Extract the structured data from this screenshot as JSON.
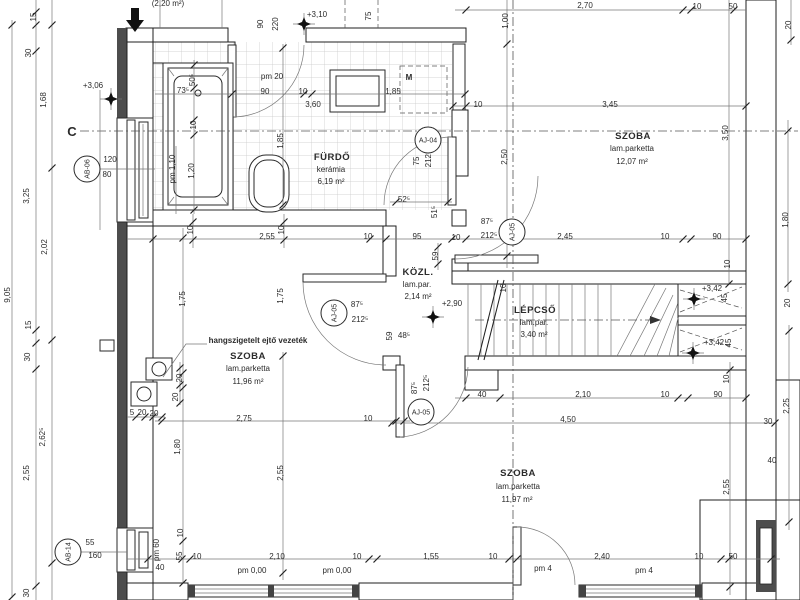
{
  "drawing": {
    "type": "architectural floor plan",
    "section_marker": "C",
    "note": "hangszigetelt ejtő vezeték"
  },
  "rooms": [
    {
      "name": "FÜRDŐ",
      "finish": "kerámia",
      "area": "6,19 m²"
    },
    {
      "name": "SZOBA",
      "finish": "lam.parketta",
      "area": "12,07 m²"
    },
    {
      "name": "KÖZL.",
      "finish": "lam.par.",
      "area": "2,14 m²"
    },
    {
      "name": "LÉPCSŐ",
      "finish": "lam.par.",
      "area": "3,40 m²"
    },
    {
      "name": "SZOBA",
      "finish": "lam.parketta",
      "area": "11,96 m²"
    },
    {
      "name": "SZOBA",
      "finish": "lam.parketta",
      "area": "11,97 m²"
    }
  ],
  "level_marks": [
    {
      "t": "+3,06",
      "x": 93,
      "y": 88
    },
    {
      "t": "+3,10",
      "x": 317,
      "y": 17
    },
    {
      "t": "+2,90",
      "x": 452,
      "y": 306
    },
    {
      "t": "+3,42",
      "x": 712,
      "y": 291
    },
    {
      "t": "+3,42",
      "x": 714,
      "y": 345
    }
  ],
  "tags": [
    {
      "id": "AB-06",
      "x": 87,
      "y": 169,
      "rot": 1
    },
    {
      "id": "AB-14",
      "x": 68,
      "y": 552,
      "rot": 1
    },
    {
      "id": "AJ-04",
      "x": 428,
      "y": 140,
      "rot": 0
    },
    {
      "id": "AJ-05",
      "x": 334,
      "y": 313,
      "rot": 1
    },
    {
      "id": "AJ-05",
      "x": 512,
      "y": 232,
      "rot": 1
    },
    {
      "id": "AJ-05",
      "x": 421,
      "y": 412,
      "rot": 0
    }
  ],
  "annotations": [
    {
      "t": "(2,20 m²)",
      "x": 168,
      "y": 6
    },
    {
      "t": "2,70",
      "x": 585,
      "y": 8
    },
    {
      "t": "10",
      "x": 697,
      "y": 9
    },
    {
      "t": "50",
      "x": 733,
      "y": 9
    },
    {
      "t": "90",
      "x": 263,
      "y": 24,
      "r": 1
    },
    {
      "t": "220",
      "x": 278,
      "y": 24,
      "r": 1
    },
    {
      "t": "75",
      "x": 371,
      "y": 16,
      "r": 1
    },
    {
      "t": "1,00",
      "x": 508,
      "y": 21,
      "r": 1
    },
    {
      "t": "20",
      "x": 791,
      "y": 25,
      "r": 1
    },
    {
      "t": "pm 20",
      "x": 272,
      "y": 79
    },
    {
      "t": "90",
      "x": 265,
      "y": 94
    },
    {
      "t": "10",
      "x": 303,
      "y": 94
    },
    {
      "t": "3,60",
      "x": 313,
      "y": 107
    },
    {
      "t": "1,85",
      "x": 393,
      "y": 94
    },
    {
      "t": "73⁵",
      "x": 183,
      "y": 93
    },
    {
      "t": "50⁵",
      "x": 195,
      "y": 80,
      "r": 1
    },
    {
      "t": "10",
      "x": 196,
      "y": 125,
      "r": 1
    },
    {
      "t": "pm 1,10",
      "x": 175,
      "y": 169,
      "r": 1
    },
    {
      "t": "1,20",
      "x": 194,
      "y": 171,
      "r": 1
    },
    {
      "t": "1,85",
      "x": 283,
      "y": 141,
      "r": 1
    },
    {
      "t": "M",
      "x": 409,
      "y": 80,
      "b": 1
    },
    {
      "t": "10",
      "x": 478,
      "y": 107
    },
    {
      "t": "3,45",
      "x": 610,
      "y": 107
    },
    {
      "t": "2,50",
      "x": 507,
      "y": 157,
      "r": 1
    },
    {
      "t": "3,50",
      "x": 728,
      "y": 133,
      "r": 1
    },
    {
      "t": "1,80",
      "x": 788,
      "y": 220,
      "r": 1
    },
    {
      "t": "10",
      "x": 193,
      "y": 230,
      "r": 1
    },
    {
      "t": "2,55",
      "x": 267,
      "y": 239
    },
    {
      "t": "10",
      "x": 284,
      "y": 230,
      "r": 1
    },
    {
      "t": "10",
      "x": 368,
      "y": 239
    },
    {
      "t": "95",
      "x": 417,
      "y": 239
    },
    {
      "t": "10",
      "x": 456,
      "y": 240
    },
    {
      "t": "2,45",
      "x": 565,
      "y": 239
    },
    {
      "t": "10",
      "x": 665,
      "y": 239
    },
    {
      "t": "90",
      "x": 717,
      "y": 239
    },
    {
      "t": "52⁵",
      "x": 404,
      "y": 202
    },
    {
      "t": "51⁵",
      "x": 437,
      "y": 212,
      "r": 1
    },
    {
      "t": "75",
      "x": 419,
      "y": 161,
      "r": 1
    },
    {
      "t": "212⁵",
      "x": 431,
      "y": 159,
      "r": 1
    },
    {
      "t": "59",
      "x": 438,
      "y": 256,
      "r": 1
    },
    {
      "t": "87⁵",
      "x": 487,
      "y": 224
    },
    {
      "t": "212⁵",
      "x": 489,
      "y": 238
    },
    {
      "t": "87⁵",
      "x": 357,
      "y": 307
    },
    {
      "t": "212⁵",
      "x": 360,
      "y": 322
    },
    {
      "t": "87⁵",
      "x": 417,
      "y": 388,
      "r": 1
    },
    {
      "t": "212⁵",
      "x": 429,
      "y": 383,
      "r": 1
    },
    {
      "t": "59",
      "x": 392,
      "y": 336,
      "r": 1
    },
    {
      "t": "48⁵",
      "x": 404,
      "y": 338
    },
    {
      "t": "1,75",
      "x": 185,
      "y": 299,
      "r": 1
    },
    {
      "t": "1,75",
      "x": 283,
      "y": 296,
      "r": 1
    },
    {
      "t": "10",
      "x": 506,
      "y": 288,
      "r": 1
    },
    {
      "t": "10",
      "x": 730,
      "y": 264,
      "r": 1
    },
    {
      "t": "45",
      "x": 727,
      "y": 298,
      "r": 1
    },
    {
      "t": "45",
      "x": 731,
      "y": 343,
      "r": 1
    },
    {
      "t": "10",
      "x": 729,
      "y": 379,
      "r": 1
    },
    {
      "t": "20",
      "x": 790,
      "y": 303,
      "r": 1
    },
    {
      "t": "20",
      "x": 182,
      "y": 378,
      "r": 1
    },
    {
      "t": "20",
      "x": 178,
      "y": 397,
      "r": 1
    },
    {
      "t": "5",
      "x": 132,
      "y": 415
    },
    {
      "t": "20",
      "x": 142,
      "y": 415
    },
    {
      "t": "20",
      "x": 154,
      "y": 416
    },
    {
      "t": "2,75",
      "x": 244,
      "y": 421
    },
    {
      "t": "10",
      "x": 368,
      "y": 421
    },
    {
      "t": "1,80",
      "x": 180,
      "y": 447,
      "r": 1
    },
    {
      "t": "2,55",
      "x": 283,
      "y": 473,
      "r": 1
    },
    {
      "t": "40",
      "x": 482,
      "y": 397
    },
    {
      "t": "2,10",
      "x": 583,
      "y": 397
    },
    {
      "t": "10",
      "x": 665,
      "y": 397
    },
    {
      "t": "90",
      "x": 718,
      "y": 397
    },
    {
      "t": "4,50",
      "x": 568,
      "y": 422
    },
    {
      "t": "2,25",
      "x": 789,
      "y": 406,
      "r": 1
    },
    {
      "t": "30",
      "x": 768,
      "y": 424
    },
    {
      "t": "40",
      "x": 772,
      "y": 463
    },
    {
      "t": "2,55",
      "x": 729,
      "y": 487,
      "r": 1
    },
    {
      "t": "10",
      "x": 183,
      "y": 533,
      "r": 1
    },
    {
      "t": "55",
      "x": 182,
      "y": 556,
      "r": 1
    },
    {
      "t": "pm 60",
      "x": 159,
      "y": 550,
      "r": 1
    },
    {
      "t": "40",
      "x": 160,
      "y": 570
    },
    {
      "t": "10",
      "x": 197,
      "y": 559
    },
    {
      "t": "2,10",
      "x": 277,
      "y": 559
    },
    {
      "t": "10",
      "x": 357,
      "y": 559
    },
    {
      "t": "pm 0,00",
      "x": 252,
      "y": 573
    },
    {
      "t": "pm 0,00",
      "x": 337,
      "y": 573
    },
    {
      "t": "1,55",
      "x": 431,
      "y": 559
    },
    {
      "t": "10",
      "x": 493,
      "y": 559
    },
    {
      "t": "2,40",
      "x": 602,
      "y": 559
    },
    {
      "t": "10",
      "x": 699,
      "y": 559
    },
    {
      "t": "50",
      "x": 733,
      "y": 559
    },
    {
      "t": "pm 4",
      "x": 543,
      "y": 571
    },
    {
      "t": "pm 4",
      "x": 644,
      "y": 573
    },
    {
      "t": "15",
      "x": 36,
      "y": 17,
      "r": 1
    },
    {
      "t": "30",
      "x": 31,
      "y": 53,
      "r": 1
    },
    {
      "t": "1,68",
      "x": 46,
      "y": 100,
      "r": 1
    },
    {
      "t": "3,25",
      "x": 29,
      "y": 196,
      "r": 1
    },
    {
      "t": "2,02",
      "x": 47,
      "y": 247,
      "r": 1
    },
    {
      "t": "15",
      "x": 31,
      "y": 325,
      "r": 1
    },
    {
      "t": "30",
      "x": 30,
      "y": 357,
      "r": 1
    },
    {
      "t": "2,62⁵",
      "x": 45,
      "y": 437,
      "r": 1
    },
    {
      "t": "2,55",
      "x": 29,
      "y": 473,
      "r": 1
    },
    {
      "t": "30",
      "x": 29,
      "y": 593,
      "r": 1
    },
    {
      "t": "9,05",
      "x": 10,
      "y": 295,
      "r": 1
    },
    {
      "t": "120",
      "x": 110,
      "y": 162
    },
    {
      "t": "80",
      "x": 107,
      "y": 177
    },
    {
      "t": "55",
      "x": 90,
      "y": 545
    },
    {
      "t": "160",
      "x": 95,
      "y": 558
    }
  ]
}
